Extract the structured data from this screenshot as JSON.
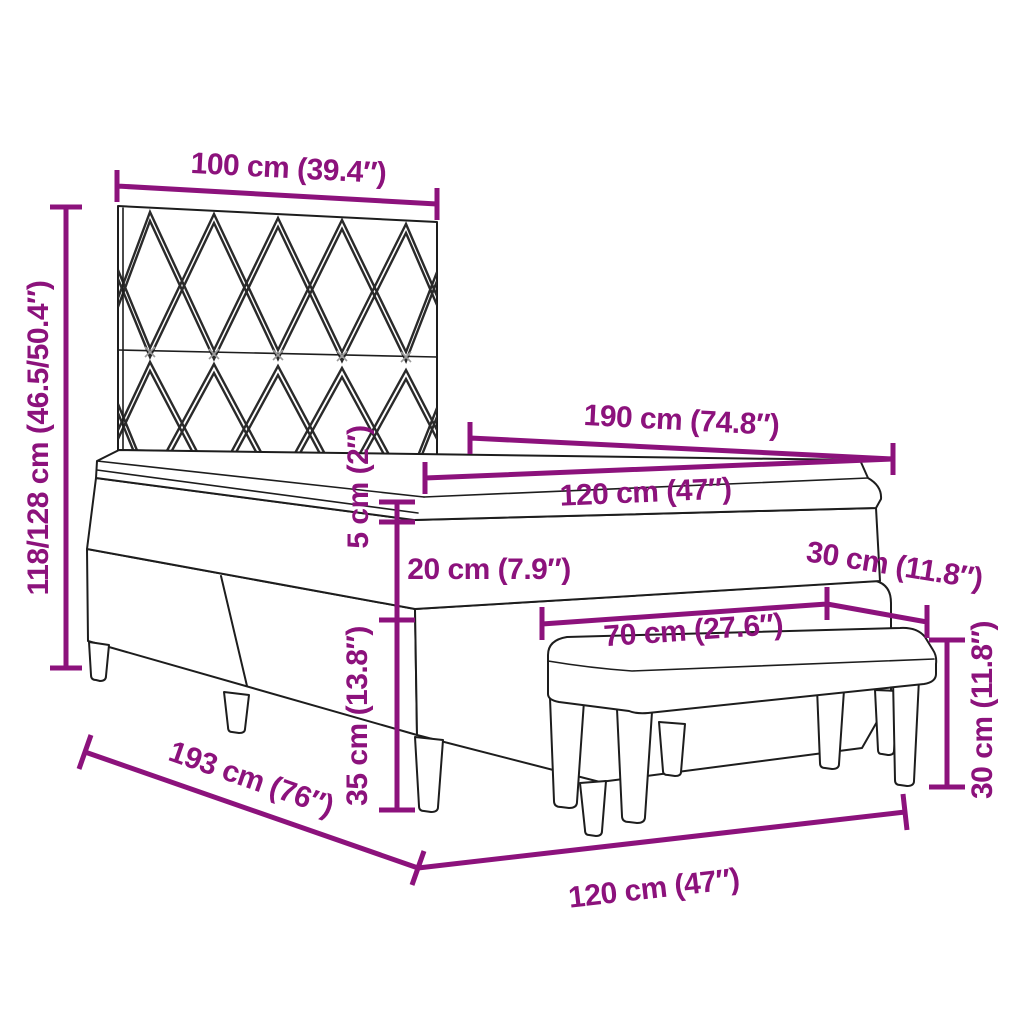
{
  "diagram": {
    "accent_color": "#8C127C",
    "line_color": "#1d1d1d",
    "background": "#ffffff",
    "labels": {
      "headboard_width": "100 cm (39.4″)",
      "overall_height": "118/128 cm (46.5/50.4″)",
      "bed_inner_length": "190 cm (74.8″)",
      "mattress_width": "120 cm (47″)",
      "topper_height": "5 cm (2″)",
      "mattress_height": "20 cm (7.9″)",
      "base_height": "35 cm (13.8″)",
      "bench_depth": "30 cm (11.8″)",
      "bench_width": "70 cm (27.6″)",
      "bench_height": "30 cm (11.8″)",
      "frame_length": "193 cm (76″)",
      "frame_width": "120 cm (47″)"
    }
  }
}
